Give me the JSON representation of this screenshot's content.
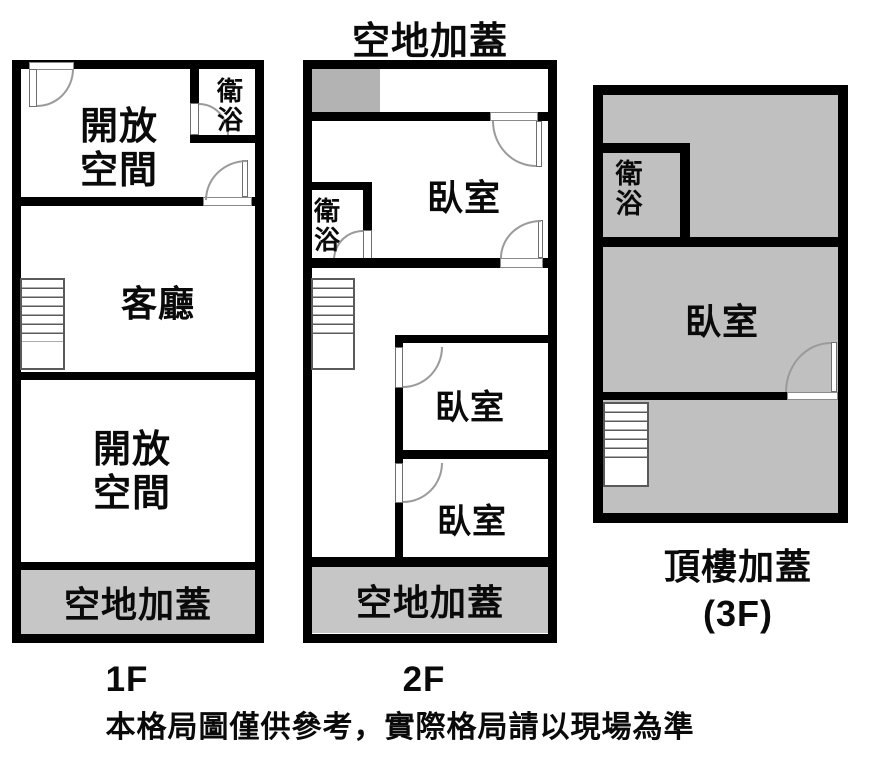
{
  "figure": {
    "caption": "本格局圖僅供參考，實際格局請以現場為準",
    "colors": {
      "wall": "#000000",
      "annex_gray": "#c0c0c0",
      "strip_gray": "#c6c6c6",
      "background": "#ffffff"
    }
  },
  "floor1": {
    "label": "1F",
    "open_space_top": "開放\n空間",
    "bathroom": "衛\n浴",
    "living_room": "客廳",
    "open_space_bottom": "開放\n空間",
    "patio": "空地加蓋"
  },
  "floor2": {
    "label": "2F",
    "roof_title": "空地加蓋",
    "bedroom_top": "臥室",
    "bathroom": "衛\n浴",
    "bedroom_mid": "臥室",
    "bedroom_bottom": "臥室",
    "patio": "空地加蓋"
  },
  "floor3": {
    "label": "頂樓加蓋\n(3F)",
    "bathroom": "衛\n浴",
    "bedroom": "臥室"
  }
}
